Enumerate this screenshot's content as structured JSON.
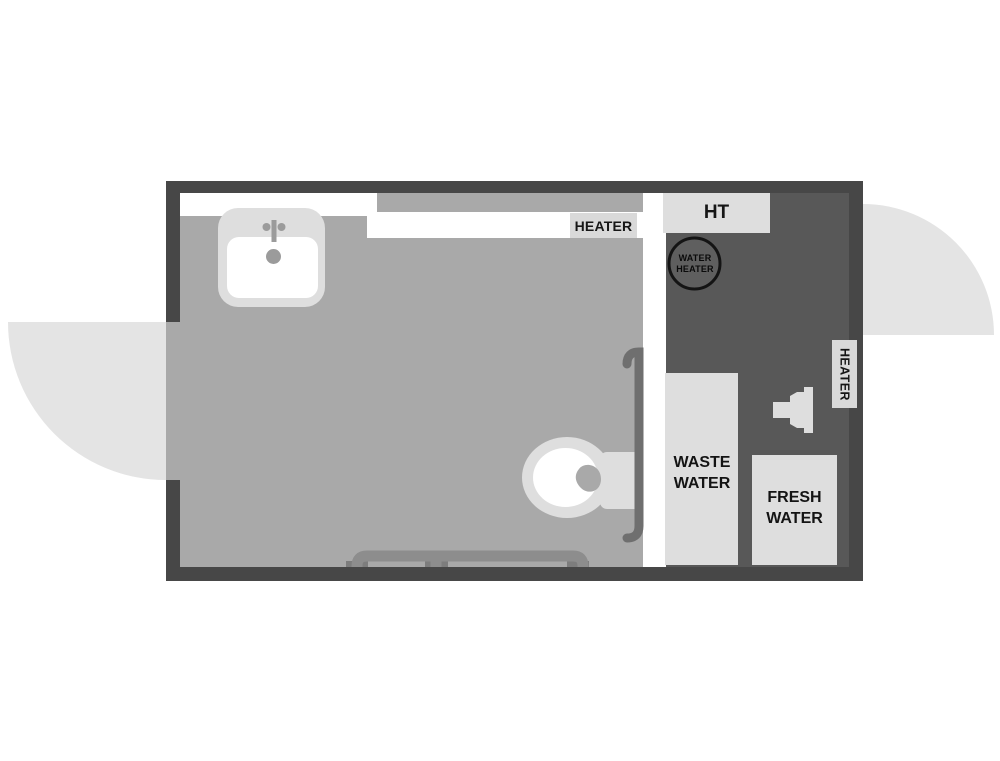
{
  "plan": {
    "title": "travel-trailer rear bath floor plan",
    "labels": {
      "heater_top": "HEATER",
      "ht": "HT",
      "water_heater": {
        "line1": "WATER",
        "line2": "HEATER"
      },
      "waste_water": {
        "line1": "WASTE",
        "line2": "WATER"
      },
      "fresh_water": {
        "line1": "FRESH",
        "line2": "WATER"
      },
      "heater_side": "HEATER"
    },
    "colors": {
      "wall": "#474747",
      "floor": "#a9a9a9",
      "utility_bay": "#585858",
      "fixture_light": "#dedede",
      "label_background": "#d9d9d9",
      "door_swing": "#e4e4e4",
      "white": "#ffffff",
      "grab_bar": "#6f6f6f",
      "towel_bar": "#8d8d8d",
      "hardware_gray": "#9b9b9b",
      "text": "#161616"
    }
  }
}
